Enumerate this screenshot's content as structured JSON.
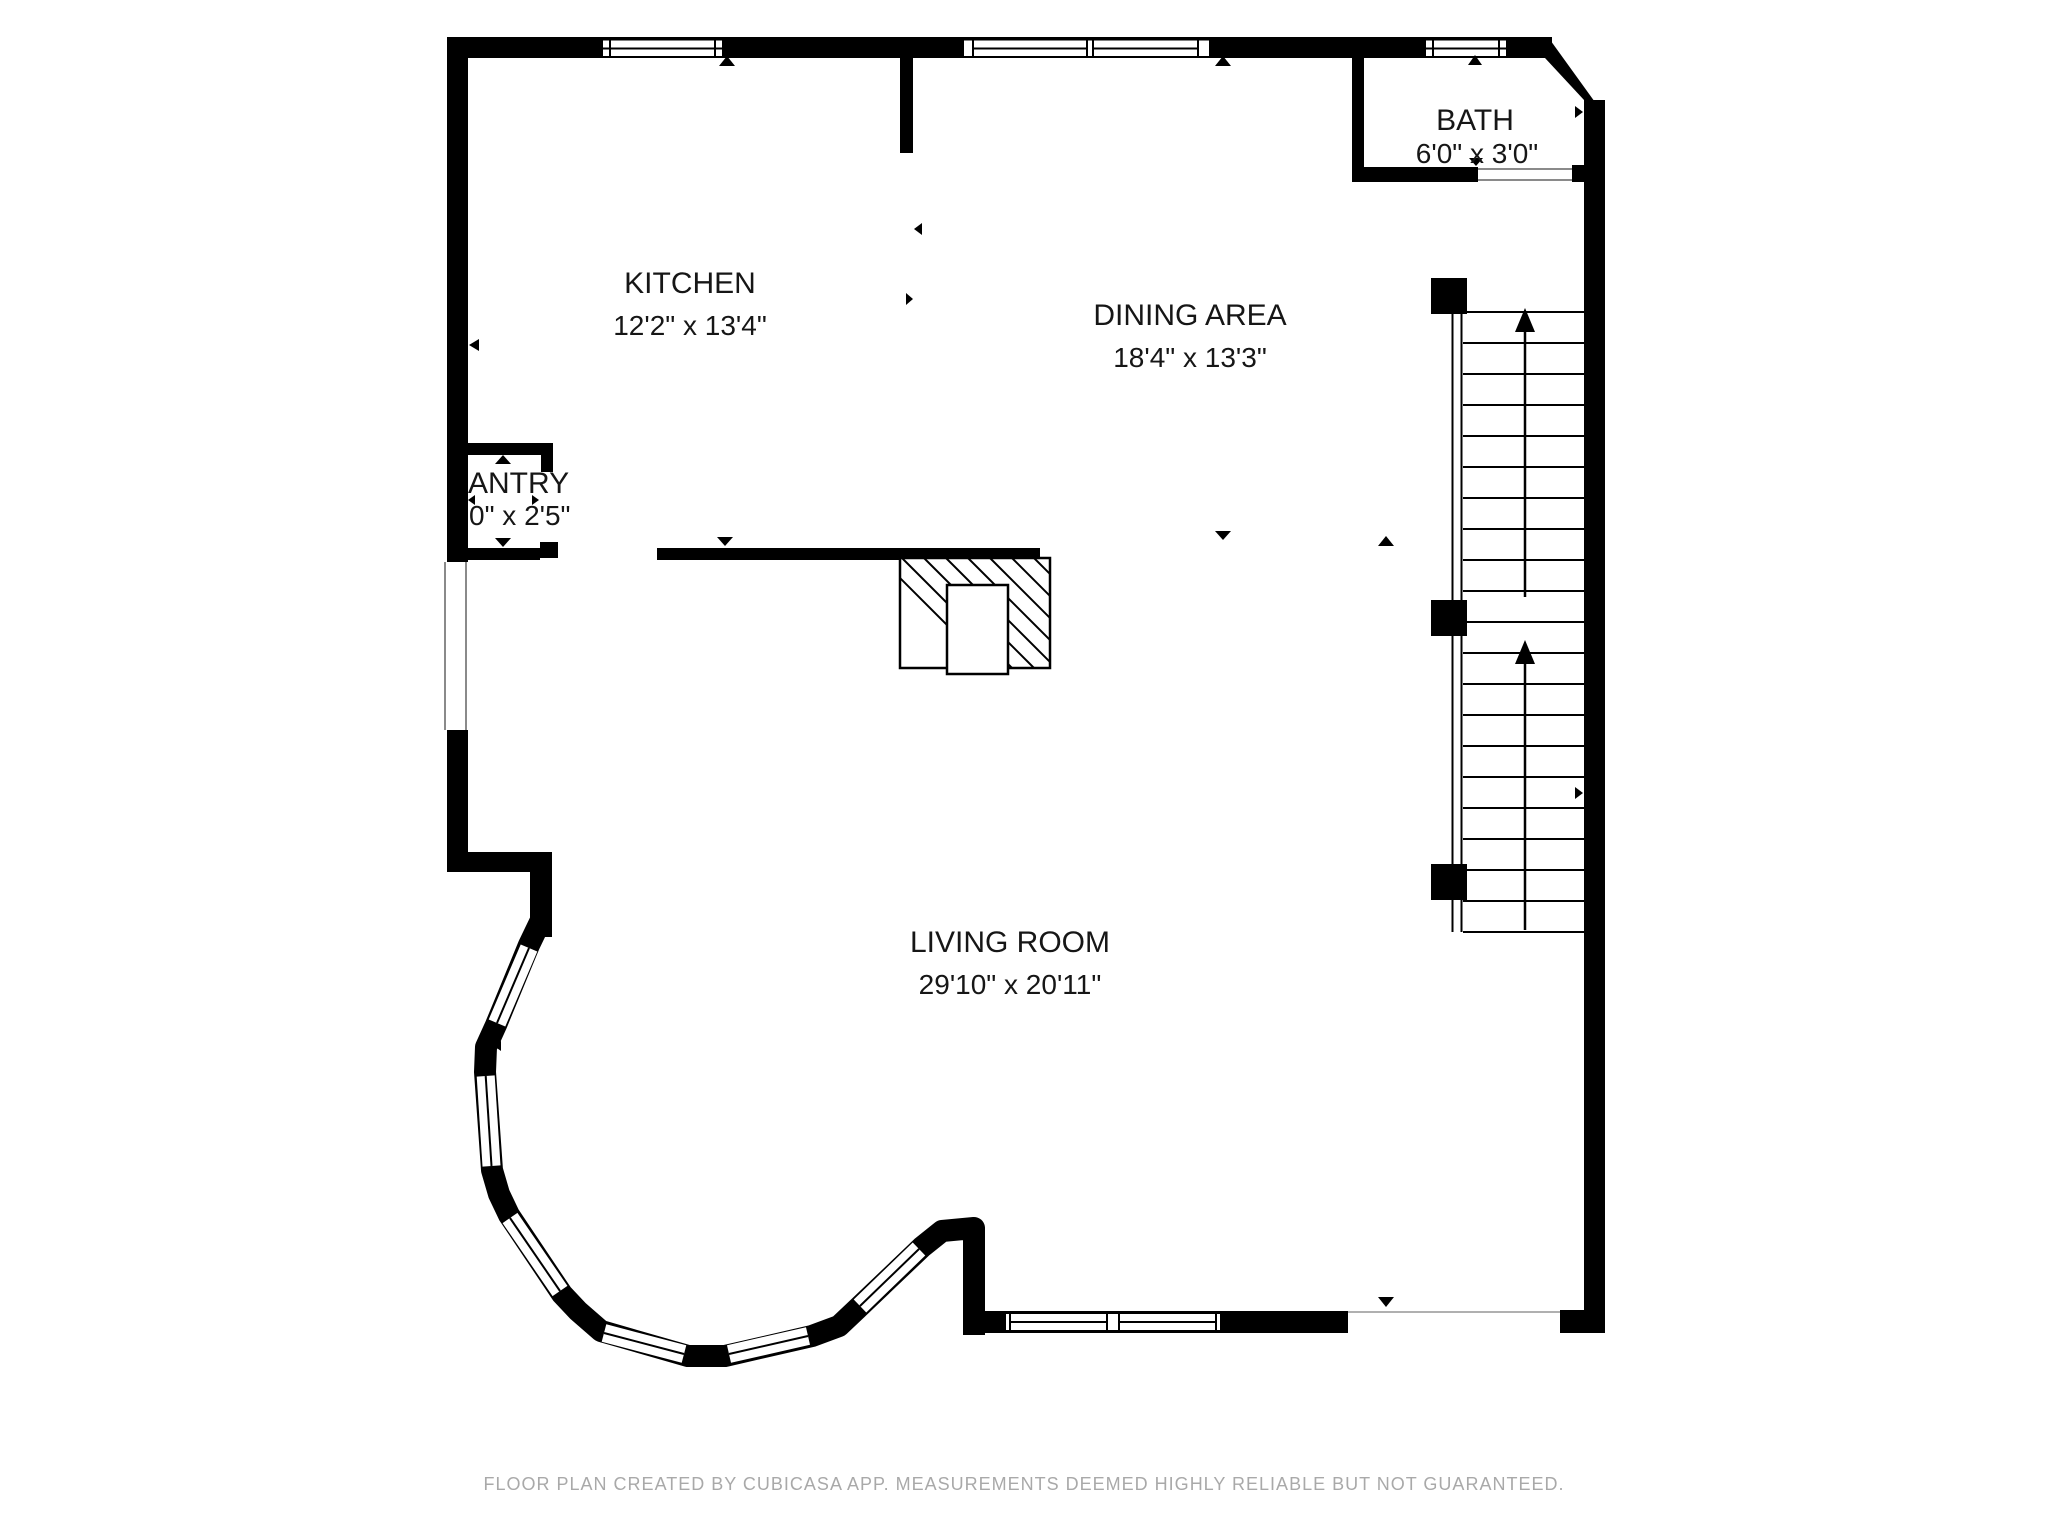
{
  "floor_plan": {
    "app_footer": "FLOOR PLAN CREATED BY CUBICASA APP. MEASUREMENTS DEEMED HIGHLY RELIABLE BUT NOT GUARANTEED.",
    "rooms": {
      "kitchen": {
        "label": "KITCHEN",
        "dimensions": "12'2\" x 13'4\""
      },
      "dining": {
        "label": "DINING AREA",
        "dimensions": "18'4\" x 13'3\""
      },
      "living": {
        "label": "LIVING ROOM",
        "dimensions": "29'10\" x 20'11\""
      },
      "bath": {
        "label": "BATH",
        "dimensions": "6'0\" x 3'0\""
      },
      "pantry": {
        "label": "ANTRY",
        "dimensions": "0\" x 2'5\""
      }
    },
    "colors": {
      "wall": "#000000",
      "background": "#ffffff",
      "footer_text": "#a9a9a9",
      "label_text": "#161616"
    },
    "elements": {
      "stairs": {
        "treads": 21,
        "posts": 3,
        "up_arrows": 2
      },
      "windows": {
        "top_wall": 3,
        "bay_segments": 6,
        "bottom_wall": 1
      },
      "fireplace": 1
    }
  }
}
